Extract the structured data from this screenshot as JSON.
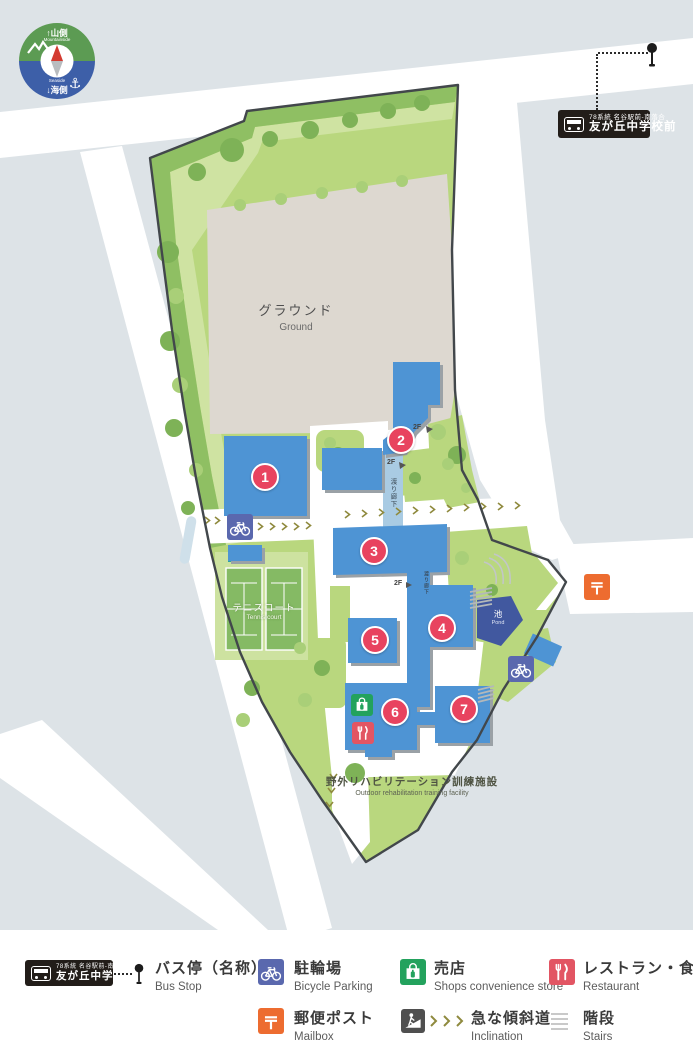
{
  "compass": {
    "mountain_label": "↑山側",
    "mountain_sub": "Mountainside",
    "sea_sub": "Seaside",
    "sea_label": "↓海側"
  },
  "bus_sign": {
    "route": "78系統 名谷駅前-南落合",
    "stop_name": "友が丘中学校前"
  },
  "map": {
    "ground": {
      "ja": "グラウンド",
      "en": "Ground"
    },
    "tennis": {
      "ja": "テニスコート",
      "en": "Tennis court"
    },
    "pond": {
      "ja": "池",
      "en": "Pond"
    },
    "walkway1": "渡り廊下",
    "walkway2": "渡り廊下",
    "outdoor": {
      "ja": "野外リハビリテーション訓練施設",
      "en": "Outdoor rehabilitation training facility"
    },
    "floor_label": "2F",
    "buildings": [
      {
        "number": "1"
      },
      {
        "number": "2"
      },
      {
        "number": "3"
      },
      {
        "number": "4"
      },
      {
        "number": "5"
      },
      {
        "number": "6"
      },
      {
        "number": "7"
      }
    ]
  },
  "legend": {
    "bus_stop": {
      "ja": "バス停（名称）",
      "en": "Bus Stop"
    },
    "bicycle_parking": {
      "ja": "駐輪場",
      "en": "Bicycle Parking"
    },
    "shop": {
      "ja": "売店",
      "en": "Shops convenience store"
    },
    "restaurant": {
      "ja": "レストラン・食堂",
      "en": "Restaurant"
    },
    "mailbox": {
      "ja": "郵便ポスト",
      "en": "Mailbox"
    },
    "incline": {
      "ja": "急な傾斜道",
      "en": "Inclination"
    },
    "stairs": {
      "ja": "階段",
      "en": "Stairs"
    }
  },
  "colors": {
    "building_blue": "#4e94d4",
    "badge_red": "#e8435f",
    "campus_green": "#b9d77e",
    "pond_blue": "#41589f",
    "mailbox_orange": "#ed6c30",
    "shop_green": "#23a25d",
    "restaurant_red": "#e25563",
    "bicycle_blue": "#5a68ae"
  }
}
